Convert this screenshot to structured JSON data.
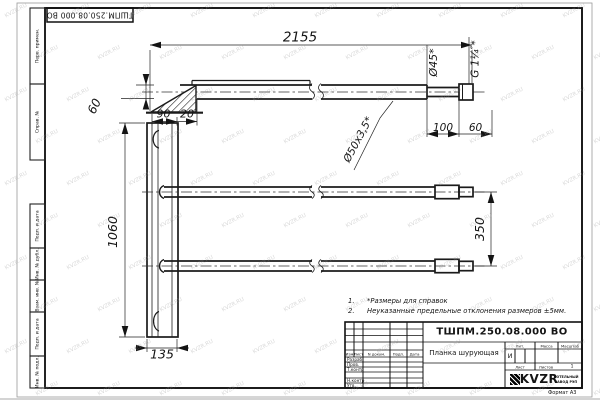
{
  "page": {
    "format_note": "Формат А3",
    "watermark": "KVZR.RU"
  },
  "top_stamp": {
    "text": "ТШПМ.250.08.000 ВО"
  },
  "margin": {
    "items": [
      {
        "label": "Перв. примен."
      },
      {
        "label": "Справ. №"
      },
      {
        "label": "Подп. и дата"
      },
      {
        "label": "Инв. № дубл."
      },
      {
        "label": "Взам. инв. №"
      },
      {
        "label": "Подп. и дата"
      },
      {
        "label": "Инв. № подл."
      }
    ]
  },
  "notes": {
    "n1_num": "1.",
    "n1_text": "*Размеры для справок",
    "n2_num": "2.",
    "n2_text": "Неуказанные предельные отклонения размеров ±5мм."
  },
  "dims": {
    "overall_length": "2155",
    "end_offset": "60",
    "plate_width": "90",
    "plate_offset": "20",
    "plank_height": "1060",
    "plank_foot": "135",
    "end_section": "100",
    "thread_section": "60",
    "end_dia": "Ø45*",
    "thread": "G 1¼″*",
    "tube_dia": "Ø50х3,5*",
    "tube_pitch": "350"
  },
  "title_block": {
    "designation": "ТШПМ.250.08.000 ВО",
    "part_name": "Планка шурующая",
    "col_izm": "Изм",
    "col_list": "Лист",
    "col_doc": "N докум.",
    "col_sign": "Подп.",
    "col_date": "Дата",
    "row_developed": "Разраб.",
    "row_checked": "Пров.",
    "row_tcontrol": "Т.контр",
    "row_ncontrol": "Н.контр",
    "row_approved": "Утв.",
    "lit_label": "Лит.",
    "lit_value": "И",
    "mass_label": "Масса",
    "scale_label": "Масштаб",
    "sheet_label": "Лист",
    "sheets_label": "Листов",
    "sheets_value": "1",
    "logo_text": "KVZR",
    "logo_line1": "КОТЕЛЬНЫЙ",
    "logo_line2": "ЗАВОД РЭП"
  }
}
